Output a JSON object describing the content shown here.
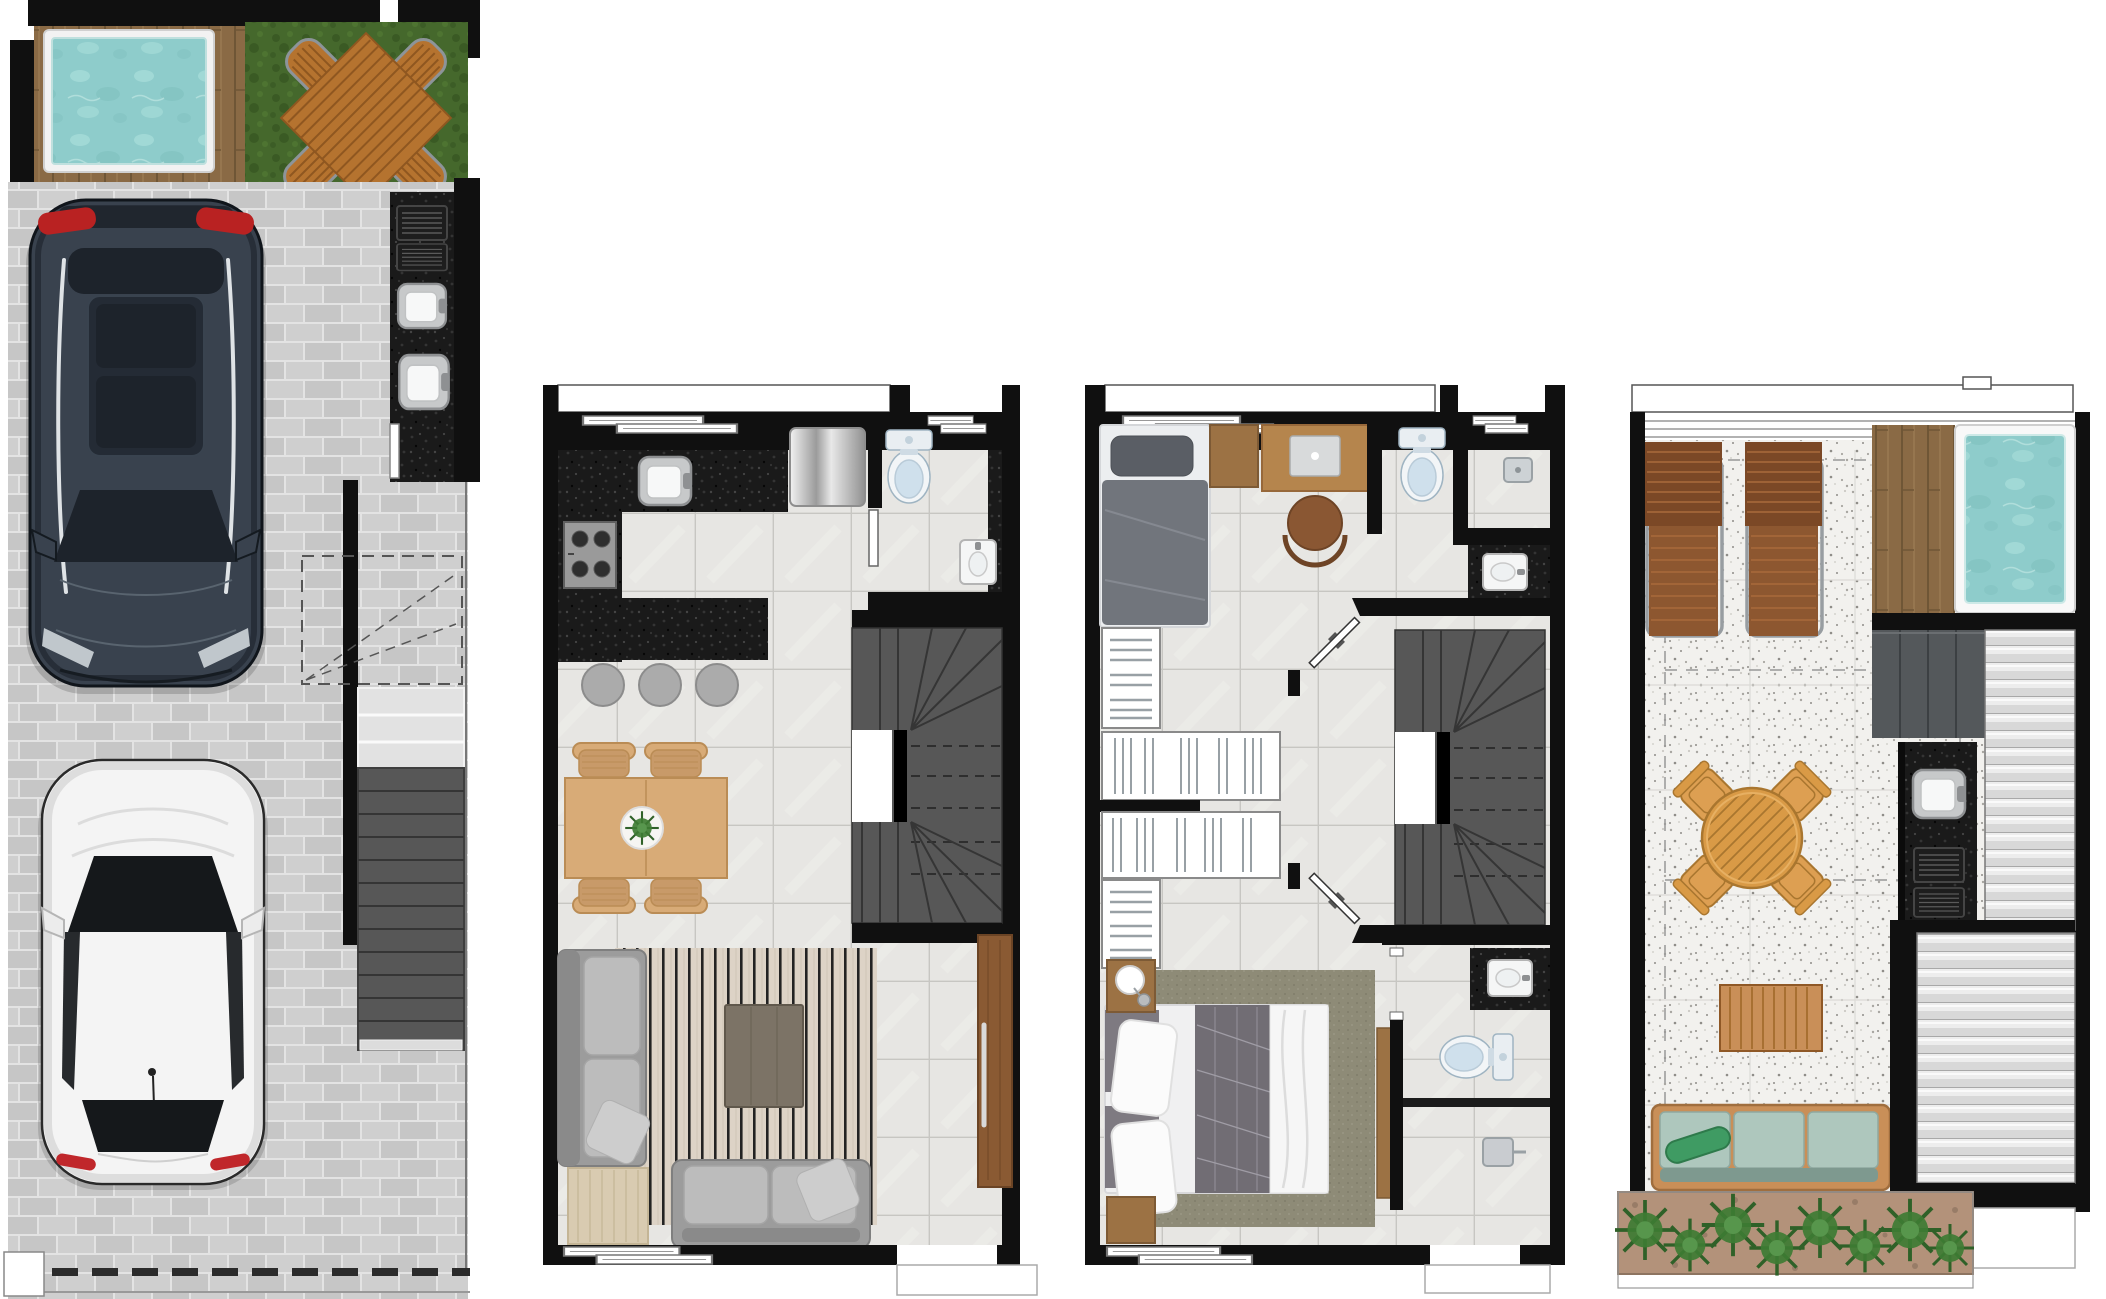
{
  "sheet": {
    "kind": "townhouse floor plan set, top-down 3D render, four levels side by side",
    "plan_count": 4
  },
  "plans": [
    {
      "id": "ground-floor",
      "items": [
        "plunge-pool",
        "timber-deck",
        "lawn",
        "picnic-table-set",
        "paved-driveway",
        "suv-car",
        "hatchback-car",
        "outdoor-kitchen-counter",
        "bbq-grills",
        "outdoor-sinks",
        "stair-landing",
        "stair-flight",
        "gate-line"
      ]
    },
    {
      "id": "living-floor",
      "items": [
        "kitchen-counter",
        "kitchen-sink",
        "cooktop",
        "refrigerator",
        "kitchen-island",
        "bar-stools",
        "powder-room-toilet",
        "powder-room-basin",
        "staircase",
        "dining-table",
        "dining-chairs",
        "centerpiece-plant",
        "area-rug",
        "chaise-sofa",
        "coffee-table",
        "two-seat-sofa",
        "side-table",
        "entry-door",
        "foyer"
      ]
    },
    {
      "id": "bedroom-floor",
      "items": [
        "single-bed",
        "nightstand",
        "study-desk",
        "desk-chair",
        "bathroom-toilet",
        "shower-head",
        "washbasin",
        "walk-in-wardrobes",
        "hall-doors",
        "staircase",
        "master-bed",
        "master-rug",
        "master-nightstands",
        "wardrobe-counter",
        "ensuite-basin",
        "ensuite-toilet",
        "ensuite-shower"
      ]
    },
    {
      "id": "rooftop",
      "items": [
        "parapet",
        "pergola-edge",
        "sun-loungers",
        "timber-deck",
        "jacuzzi",
        "solar-panels",
        "louvered-roof",
        "bbq-counter",
        "bbq-sink",
        "bbq-grills",
        "round-dining-table",
        "dining-armchairs",
        "coffee-table",
        "outdoor-sofa",
        "planter-bed"
      ]
    }
  ],
  "palette": {
    "wall": "#101010",
    "white": "#ffffff",
    "line": "#666666",
    "paver1": "#c6c6c6",
    "paver2": "#cfcfcf",
    "paverJoint": "#e3e3e3",
    "deckWood": "#8a6a45",
    "deckLine": "#6f5636",
    "deckLight": "#9a7a52",
    "grass1": "#45682c",
    "grass2": "#3a5a24",
    "grass3": "#527a33",
    "water1": "#8ecccb",
    "water2": "#a6dcd8",
    "water3": "#7cbdbc",
    "poolRim": "#f2f2f2",
    "benchWood": "#b5732f",
    "benchLine": "#8f5720",
    "benchFrame": "#8d9499",
    "granite": "#1a1a1a",
    "fleck1": "#343434",
    "fleck2": "#060606",
    "fleck3": "#454545",
    "steel": "#c7c9ca",
    "steelDark": "#8e9092",
    "basin": "#f5f6f6",
    "tile": "#e7e6e3",
    "tileLine": "#c7c6c2",
    "tileStreak": "#efeeea",
    "stair": "#575757",
    "stairLine": "#353535",
    "stairDash": "#2e2e2e",
    "woodTable": "#d8ab77",
    "woodTableLine": "#ba8c55",
    "chairWood": "#c89a69",
    "stool": "#ababab",
    "stoolLine": "#8c8c8c",
    "rugBase": "#ddd3c6",
    "rugStripe": "#232323",
    "rugThin": "#cfc5b6",
    "sofa": "#9c9c9c",
    "sofaCushion": "#bcbcbc",
    "sofaDark": "#8a8a8a",
    "pillow": "#cdcdcd",
    "ctable": "#7c7366",
    "ctableLine": "#60584c",
    "sideTable": "#d9cbb1",
    "sideTableLine": "#c4b596",
    "doorWood": "#8a5a33",
    "doorWoodLine": "#6b4425",
    "handle": "#d9d9d9",
    "silverA": "#f2f2f2",
    "silverB": "#9b9b9b",
    "toiletBody": "#f2f5f7",
    "toiletLid": "#cfe0ec",
    "toiletLine": "#9fb4c2",
    "bedBase": "#eceef0",
    "duvetSingle": "#71757c",
    "pillowSingle": "#5a5e65",
    "foldLine": "#8b8f96",
    "deskWood": "#b5854d",
    "deskLine": "#97683a",
    "chairBrown": "#8a5733",
    "chairBrownDark": "#6e4426",
    "laptop": "#d8dadb",
    "closetLine": "#98a0a5",
    "closetFrame": "#8a8a8a",
    "rugMaster": "#8e8b77",
    "rugMasterDot": "#827f6c",
    "rugMasterDot2": "#9a9784",
    "duvetMaster": "#716d74",
    "duvetLine": "#a5a2ab",
    "blanket": "#f6f6f6",
    "nightWood": "#9c7244",
    "nightWoodLine": "#7d5a35",
    "terrazzo": "#f2f1ee",
    "terrFleck": "#a8a6a1",
    "terrFleck2": "#8f8d88",
    "terrFleck3": "#cbc9c4",
    "loungeDark": "#7b4826",
    "loungeMid": "#8d5730",
    "loungeLine": "#a96a3b",
    "loungeFrame": "#989da1",
    "teak": "#d99a46",
    "teakLine": "#a9762f",
    "teakChair": "#dd9f52",
    "solar": "#54585b",
    "solarLine": "#3c4043",
    "roofBase": "#ededed",
    "roofStripe": "#d8d8d8",
    "roofLine": "#a8a8a8",
    "grate": "#1d1d1d",
    "grateLine": "#5a5a5a",
    "outWood": "#c98f58",
    "outWoodLine": "#a06e3e",
    "outCushion": "#aec7bd",
    "outCushionLine": "#8fa9a0",
    "outEdge": "#7e998f",
    "bolster": "#3f9b63",
    "bolsterLine": "#2e7a4b",
    "soil": "#b3927a",
    "soilDot": "#8d7460",
    "plant1": "#3e7c33",
    "plant2": "#2f6128",
    "plant3": "#5a9a50",
    "carNavy": "#39424e",
    "carNavyDark": "#20262e",
    "carGlass": "#1d232b",
    "carRed": "#b92222",
    "carEdge": "#10151b",
    "railWhite": "#dfe3e6",
    "hoodLine": "#59646f",
    "headlight": "#cfd6da",
    "carWhite": "#f4f4f4",
    "carWhiteShade": "#d7d7d7",
    "glassDark": "#15181b",
    "tailRed": "#c0272b"
  }
}
